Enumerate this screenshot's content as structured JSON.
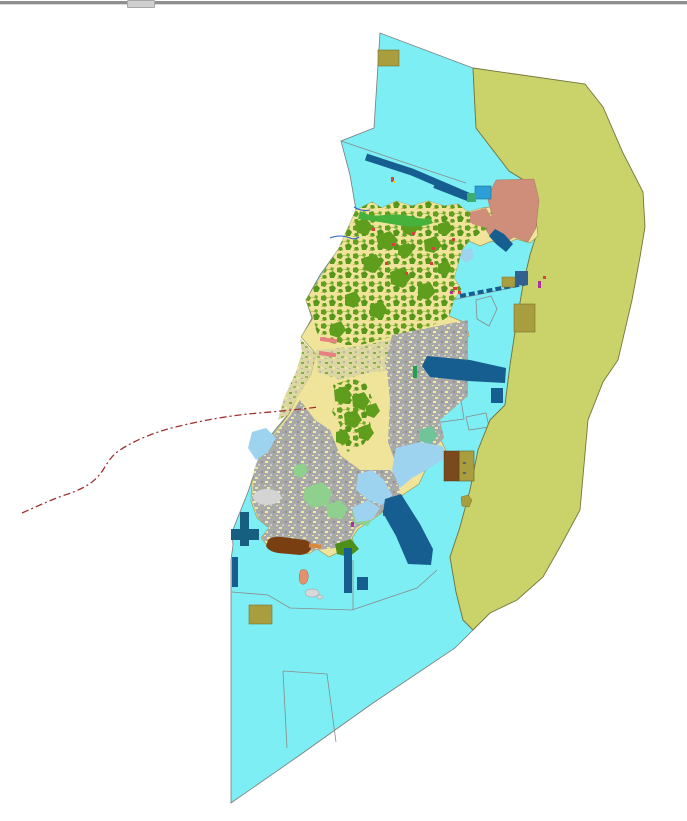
{
  "frame": {
    "top_bar_color": "#8f8f8f",
    "handle_color": "#cfcfcf"
  },
  "map": {
    "background_color": "#ffffff",
    "colors": {
      "water": "#7DEFF4",
      "buffer": "#C9D36A",
      "buffer_outline": "#75753d",
      "island_base": "#F0E49B",
      "island_outline": "#9a9a5a",
      "forest": "#5E9E1C",
      "forest_dark": "#4E8F1A",
      "urban": "#A9A9A9",
      "light_green": "#8FD08F",
      "teal_green": "#6FC49A",
      "bright_green": "#46B23C",
      "light_blue": "#9ED3F0",
      "navy": "#155E8F",
      "teal_pier": "#175F80",
      "medium_blue": "#2D9FD6",
      "khaki": "#A89D3F",
      "salmon": "#CE8E7A",
      "salmon_bright": "#E8906B",
      "brown": "#7A3F10",
      "dark_brown": "#7A4A1E",
      "orange": "#D9883A",
      "pink": "#E88080",
      "red_dot": "#D94040",
      "magenta": "#B030A0",
      "boundary_red": "#A03030",
      "outline_gray": "#8a8a8a",
      "stream_blue": "#2B64C8",
      "gray_flat": "#D4D4D4",
      "islet_gray": "#D8D8D8"
    },
    "features": [
      {
        "id": "water-zone",
        "label": "coastal water zone"
      },
      {
        "id": "buffer-zone",
        "label": "eastern buffer zone"
      },
      {
        "id": "island-landmass",
        "label": "island land-use area"
      },
      {
        "id": "boundary-line",
        "label": "dashed administrative boundary"
      },
      {
        "id": "breakwater-band",
        "label": "north breakwater"
      },
      {
        "id": "harbor-basin",
        "label": "east harbor basin"
      },
      {
        "id": "bridge-causeway",
        "label": "dashed bridge causeway"
      },
      {
        "id": "jetty-t-pier",
        "label": "west T-shaped jetty"
      },
      {
        "id": "khaki-plots",
        "label": "khaki reserved plots"
      },
      {
        "id": "salmon-district",
        "label": "northeast salmon district"
      },
      {
        "id": "parcel-outlines",
        "label": "unfilled sea parcels"
      }
    ]
  }
}
